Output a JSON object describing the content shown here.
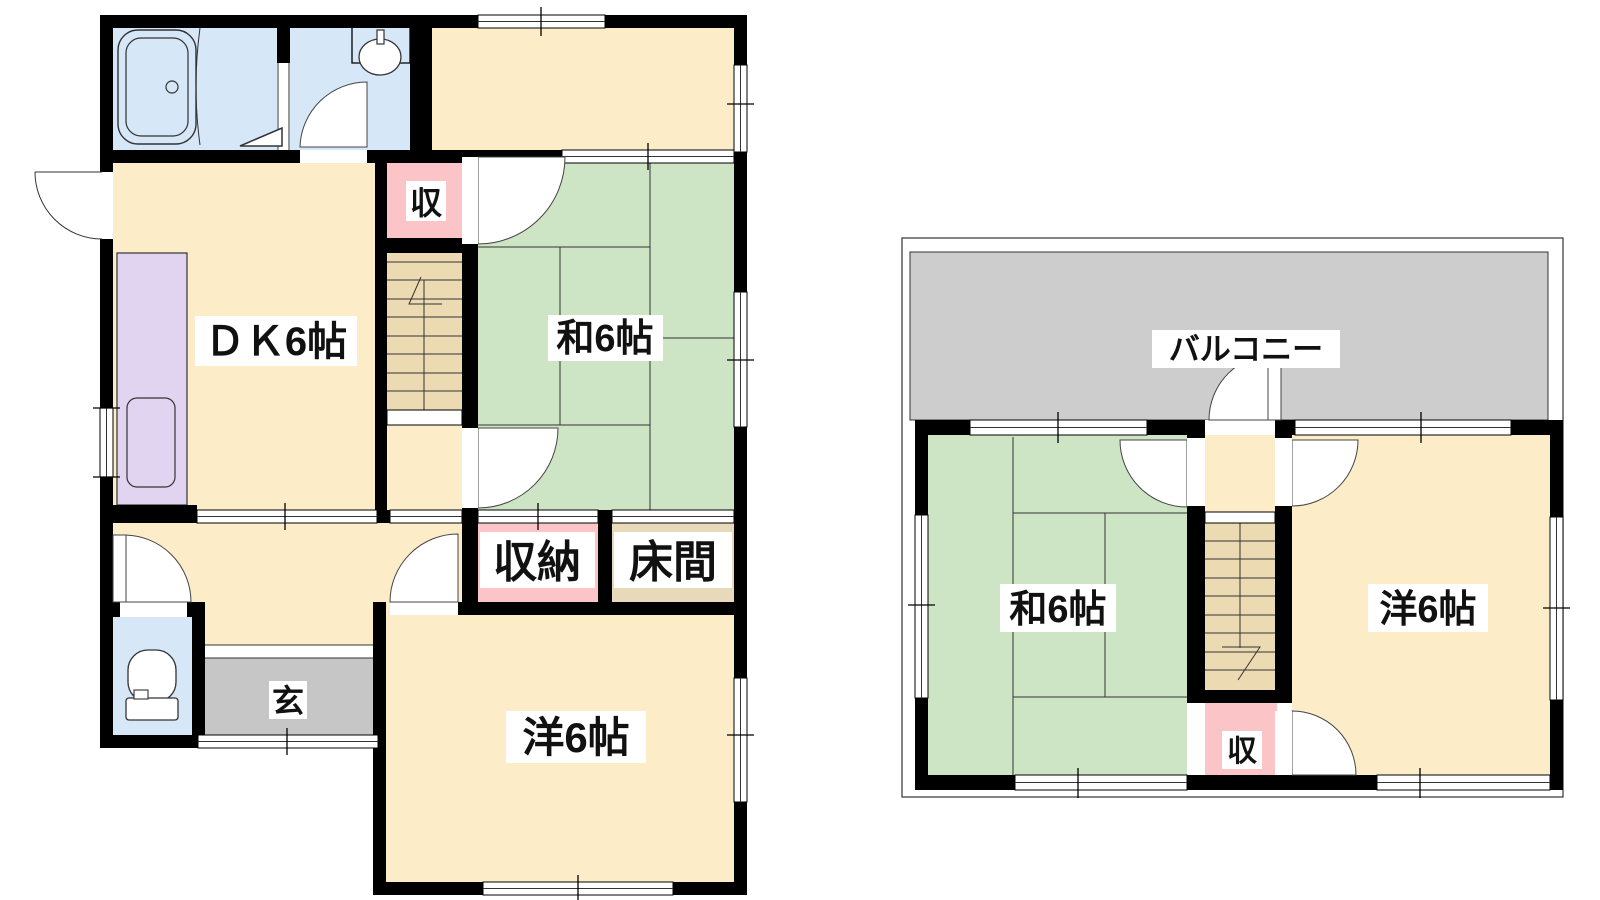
{
  "plan_title": "2-story house floor plan",
  "palette": {
    "wall": "#000000",
    "cream": "#fcedc8",
    "green": "#cde4c5",
    "pink": "#fbc5c8",
    "blue": "#d6e7f8",
    "purple": "#e0d4f0",
    "balcony": "#cdcdcd",
    "genkan": "#c6c6c6",
    "stairs": "#ecdab2",
    "tokonoma": "#e8d9ba"
  },
  "floor1": {
    "labels": {
      "dk": "ＤＫ6帖",
      "washitsu": "和6帖",
      "closet": "収",
      "storage": "収納",
      "tokonoma": "床間",
      "entrance": "玄",
      "western": "洋6帖"
    }
  },
  "floor2": {
    "labels": {
      "balcony": "バルコニー",
      "washitsu": "和6帖",
      "western": "洋6帖",
      "closet": "収"
    }
  }
}
